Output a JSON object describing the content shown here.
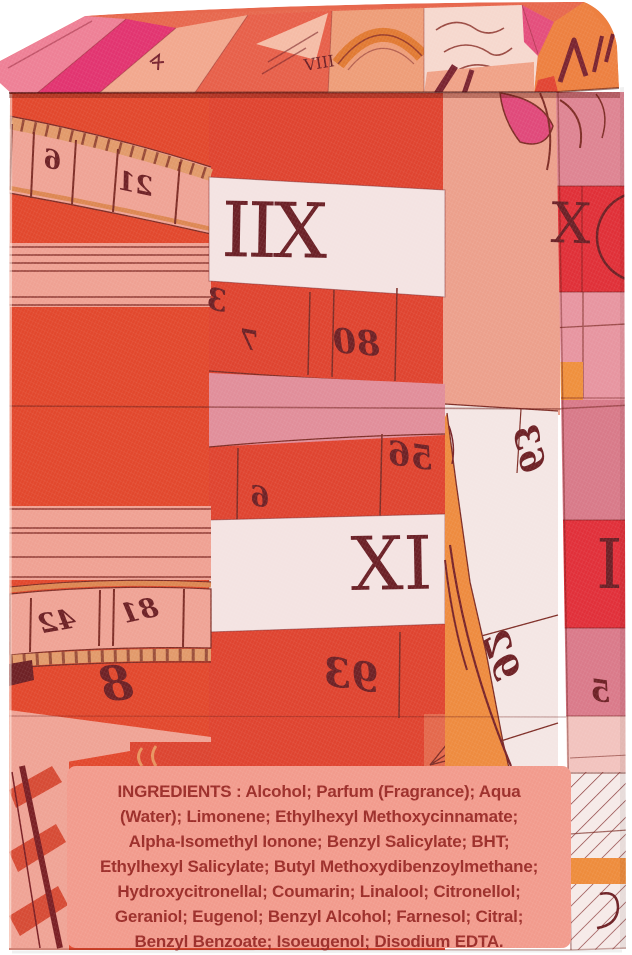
{
  "photo": {
    "subject": "perfume box with mirrored sundial scarf print",
    "background": "#ffffff"
  },
  "palette": {
    "ink_maroon": "#6E2125",
    "base_red": "#E2482D",
    "center_red": "#DF4430",
    "salmon": "#ECA08C",
    "salmon_band": "#EFA395",
    "band_white": "#F4E3E2",
    "pink_band": "#E18E9A",
    "side_rose": "#DE8492",
    "side_red": "#E03038",
    "orange": "#EE8B3F",
    "label_bg": "#F29B8D",
    "label_text": "#9C2D29"
  },
  "markings": {
    "lid_viii": "VIII",
    "tape6": "6",
    "tape12": "12",
    "iix": "IIX",
    "c3": "3",
    "c7": "7",
    "c08": "08",
    "c65": "65",
    "c6": "6",
    "xi": "XI",
    "c39": "39",
    "b36": "36",
    "b29": "29",
    "a24": "24",
    "a18": "18",
    "a8": "8",
    "side_x": "X",
    "side_i": "I",
    "side_5": "5"
  },
  "label": {
    "lines": [
      "INGREDIENTS : Alcohol; Parfum (Fragrance); Aqua",
      "(Water); Limonene; Ethylhexyl Methoxycinnamate;",
      "Alpha-Isomethyl Ionone; Benzyl Salicylate; BHT;",
      "Ethylhexyl Salicylate; Butyl Methoxydibenzoylmethane;",
      "Hydroxycitronellal; Coumarin; Linalool; Citronellol;",
      "Geraniol; Eugenol; Benzyl Alcohol; Farnesol; Citral;",
      "Benzyl Benzoate; Isoeugenol; Disodium EDTA."
    ]
  }
}
